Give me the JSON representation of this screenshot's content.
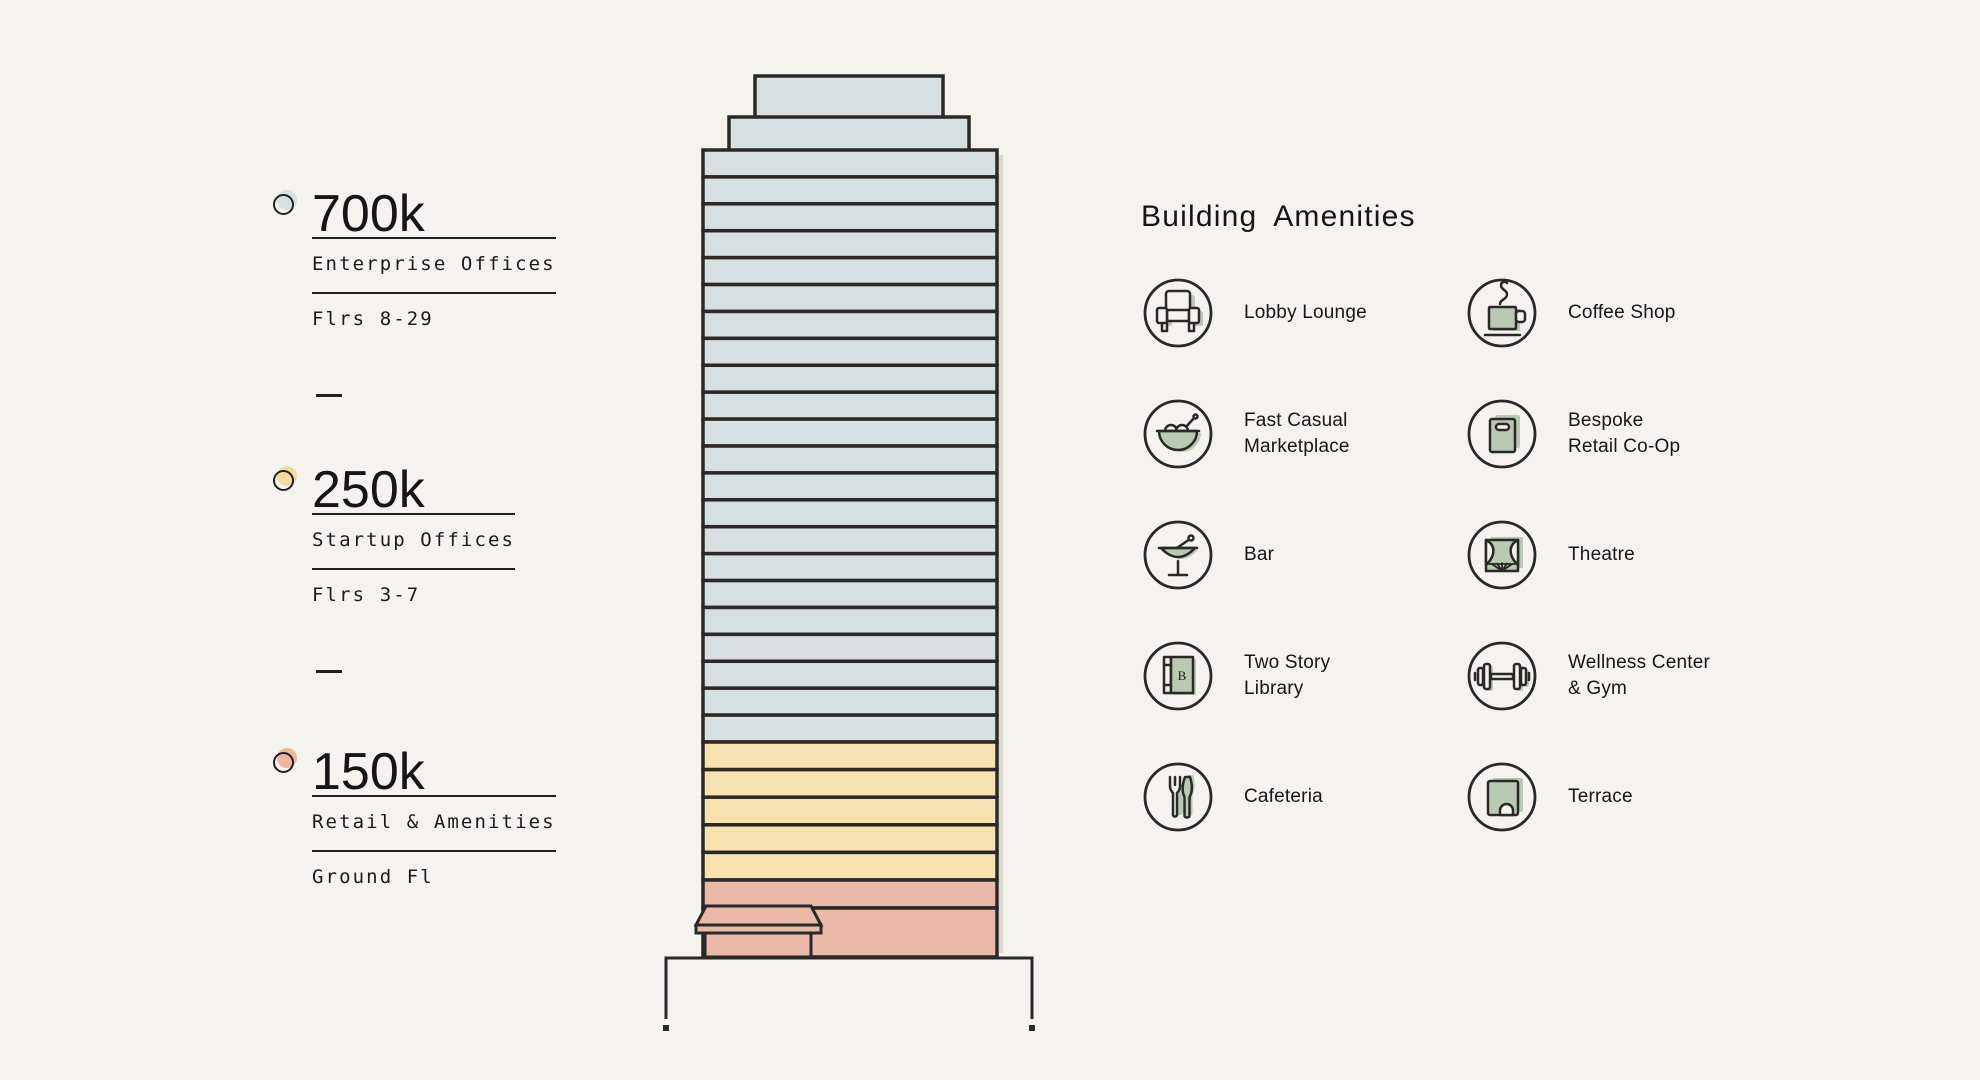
{
  "palette": {
    "background": "#f4f3ee",
    "outline": "#2b2926",
    "ink": "#1b1b1b",
    "floor_blue": "#d7e0e1",
    "floor_yellow": "#f6e3af",
    "floor_pink": "#eab9a8",
    "sage": "#bac9b3"
  },
  "legend": {
    "sections": [
      {
        "value": "700k",
        "label": "Enterprise Offices",
        "floors": "Flrs 8-29",
        "bullet_color": "#d7e0e1"
      },
      {
        "value": "250k",
        "label": "Startup Offices",
        "floors": "Flrs 3-7",
        "bullet_color": "#f1dba1"
      },
      {
        "value": "150k",
        "label": "Retail & Amenities",
        "floors": "Ground Fl",
        "bullet_color": "#efb5a2"
      }
    ]
  },
  "building": {
    "body": {
      "left": 703,
      "top": 150,
      "width": 294,
      "bottom": 957
    },
    "crown": [
      {
        "x": 755,
        "y": 76,
        "w": 188,
        "h": 45
      },
      {
        "x": 729,
        "y": 117,
        "w": 240,
        "h": 37
      }
    ],
    "segments": [
      {
        "name": "enterprise-offices",
        "floors": 22,
        "color": "#d7e0e1",
        "bottom": 742
      },
      {
        "name": "startup-offices",
        "floors": 5,
        "color": "#f6e3af",
        "bottom": 880
      },
      {
        "name": "retail-mezzanine",
        "floors": 1,
        "color": "#eab9a8",
        "bottom": 908
      }
    ],
    "ground": {
      "color": "#eab9a8",
      "top": 908,
      "bottom": 957
    }
  },
  "amenities": {
    "title": "Building Amenities",
    "items": [
      {
        "label": "Lobby Lounge",
        "icon": "armchair-icon"
      },
      {
        "label": "Coffee Shop",
        "icon": "coffee-cup-icon"
      },
      {
        "label": "Fast Casual\nMarketplace",
        "icon": "salad-bowl-icon"
      },
      {
        "label": "Bespoke\nRetail Co-Op",
        "icon": "shopping-bag-icon"
      },
      {
        "label": "Bar",
        "icon": "cocktail-glass-icon"
      },
      {
        "label": "Theatre",
        "icon": "theatre-stage-icon"
      },
      {
        "label": "Two Story\nLibrary",
        "icon": "book-icon"
      },
      {
        "label": "Wellness Center\n& Gym",
        "icon": "dumbbell-icon"
      },
      {
        "label": "Cafeteria",
        "icon": "fork-knife-icon"
      },
      {
        "label": "Terrace",
        "icon": "terrace-icon"
      }
    ]
  }
}
